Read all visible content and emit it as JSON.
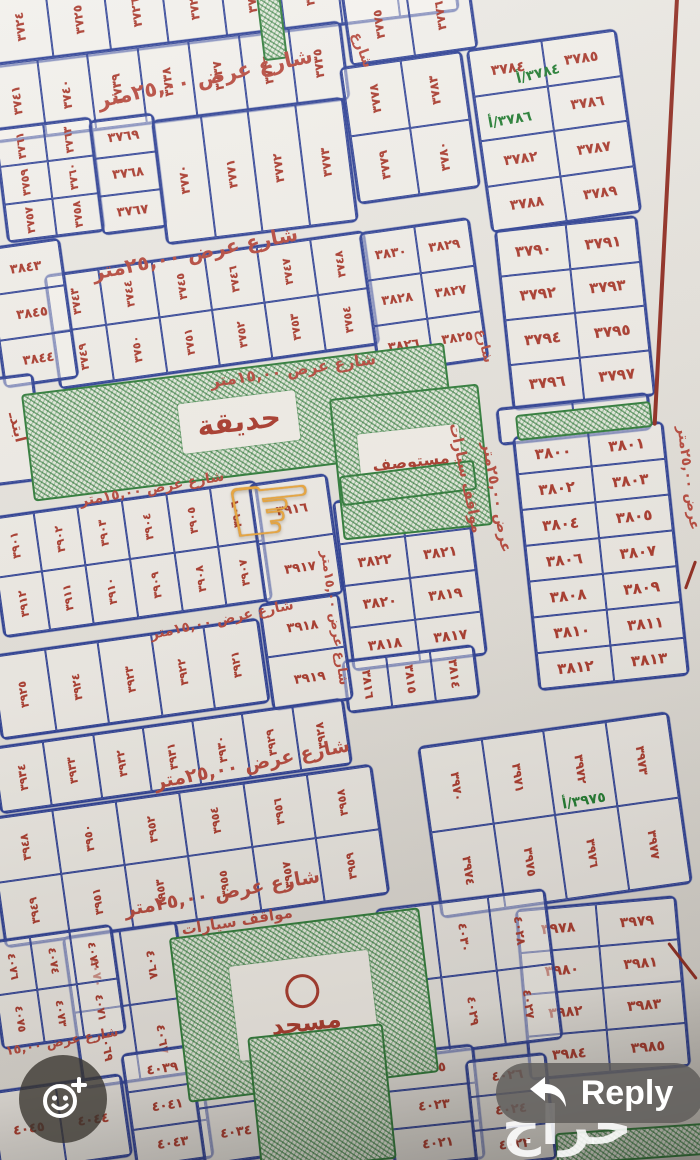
{
  "ui": {
    "reply_button": {
      "label": "Reply"
    },
    "watermark": "حراج"
  },
  "map": {
    "palette": {
      "ink_blue": "#2c3f94",
      "ink_red": "#a8392c",
      "ink_green": "#1f7a2f",
      "street_red": "#b5483c",
      "border_red": "#8f2b20",
      "paper": "#e6e3dd"
    },
    "pointer": {
      "glyph": "☞",
      "x": 224,
      "y": 462,
      "size": 104,
      "rot": -6,
      "target_plot": "٣٨٢٤"
    },
    "areas": [
      {
        "name": "garden",
        "label": "حديقة",
        "x": 26,
        "y": 368,
        "w": 422,
        "h": 104,
        "rot": -7,
        "hatch": true,
        "lw": 118,
        "lh": 50,
        "fs": 28
      },
      {
        "name": "clinic",
        "label": "مستوصف",
        "x": 336,
        "y": 391,
        "w": 146,
        "h": 138,
        "rot": -6,
        "hatch": true,
        "lw": 102,
        "lh": 66,
        "fs": 16
      },
      {
        "name": "mosque",
        "label": "مسجد",
        "x": 178,
        "y": 922,
        "w": 248,
        "h": 162,
        "rot": -7,
        "hatch": true,
        "lw": 140,
        "lh": 95,
        "fs": 24
      },
      {
        "name": "green-strip-top",
        "label": "",
        "x": 260,
        "y": -6,
        "w": 20,
        "h": 62,
        "rot": -7,
        "hatch": true
      },
      {
        "name": "green-strip-3800",
        "label": "",
        "x": 516,
        "y": 408,
        "w": 132,
        "h": 22,
        "rot": -6,
        "hatch": true
      },
      {
        "name": "green-strip-3824",
        "label": "",
        "x": 340,
        "y": 468,
        "w": 132,
        "h": 26,
        "rot": -7,
        "hatch": true
      },
      {
        "name": "green-block-bottom",
        "label": "",
        "x": 254,
        "y": 1030,
        "w": 132,
        "h": 132,
        "rot": -6,
        "hatch": true
      },
      {
        "name": "green-strip-bottom-right",
        "label": "",
        "x": 556,
        "y": 1128,
        "w": 148,
        "h": 28,
        "rot": -4,
        "hatch": true
      }
    ],
    "streets": [
      {
        "label": "شارع عرض ٢٥,٠٠متر",
        "x": 205,
        "y": 78,
        "rot": -12,
        "size": 21
      },
      {
        "label": "شارع",
        "x": 362,
        "y": 50,
        "rot": 70,
        "size": 14
      },
      {
        "label": "شارع عرض ٢٥,٠٠متر",
        "x": 195,
        "y": 253,
        "rot": -11,
        "size": 20
      },
      {
        "label": "شارع عرض ١٥,٠٠متر",
        "x": 293,
        "y": 370,
        "rot": -8,
        "size": 16
      },
      {
        "label": "شارع عرض ١٥,٠٠متر",
        "x": 152,
        "y": 489,
        "rot": -10,
        "size": 14
      },
      {
        "label": "مواقف سيارات",
        "x": 466,
        "y": 478,
        "rot": 78,
        "size": 15
      },
      {
        "label": "عرض ٢٥,٠٠متر",
        "x": 497,
        "y": 497,
        "rot": 80,
        "size": 15
      },
      {
        "label": "شارع عرض ١٥,٠٠متر",
        "x": 334,
        "y": 618,
        "rot": 82,
        "size": 13
      },
      {
        "label": "شارع عرض ١٥,٠٠متر",
        "x": 222,
        "y": 620,
        "rot": -12,
        "size": 14
      },
      {
        "label": "شارع عرض ٢٥,٠٠متر",
        "x": 252,
        "y": 764,
        "rot": -11,
        "size": 19
      },
      {
        "label": "شارع عرض ٢٥,٠٠متر",
        "x": 222,
        "y": 893,
        "rot": -10,
        "size": 19
      },
      {
        "label": "مواقف سيارات",
        "x": 237,
        "y": 921,
        "rot": -9,
        "size": 15
      },
      {
        "label": "شارع عرض ١٥,٠٠",
        "x": 62,
        "y": 1042,
        "rot": -10,
        "size": 13
      },
      {
        "label": "عرض ٢٥,٠٠متر",
        "x": 688,
        "y": 478,
        "rot": 83,
        "size": 14
      },
      {
        "label": "شارع",
        "x": 484,
        "y": 346,
        "rot": 76,
        "size": 13
      }
    ],
    "annotations": [
      {
        "text": "٣٧٨٤/أ",
        "x": 516,
        "y": 66,
        "rot": -14,
        "size": 14,
        "color": "#1f7a2f"
      },
      {
        "text": "٣٧٨٦/أ",
        "x": 488,
        "y": 112,
        "rot": -10,
        "size": 14,
        "color": "#1f7a2f"
      },
      {
        "text": "٣٩٧٥/أ",
        "x": 562,
        "y": 793,
        "rot": -10,
        "size": 14,
        "color": "#1f7a2f"
      },
      {
        "text": "ابتدـ",
        "x": 2,
        "y": 418,
        "rot": 76,
        "size": 15,
        "color": "#a8392c"
      }
    ],
    "strokes": [
      {
        "x": 664,
        "y": -10,
        "w": 4,
        "h": 436,
        "rot": 3
      },
      {
        "x": 681,
        "y": 938,
        "w": 3,
        "h": 46,
        "rot": -38
      },
      {
        "x": 689,
        "y": 560,
        "w": 3,
        "h": 30,
        "rot": 20
      }
    ],
    "blocks": [
      {
        "x": -12,
        "y": -36,
        "w": 465,
        "h": 72,
        "rot": -7,
        "cols": 8,
        "labelRot": -90,
        "size": 12,
        "cells": [
          "٣٧٢٤",
          "٣٧٢٥",
          "٣٧٢٦",
          "٣٧٢٧",
          "٣٧٢٨",
          "٣٧٢٩",
          "٣٧٣٠",
          "٣٧٣١"
        ]
      },
      {
        "x": -12,
        "y": 42,
        "w": 355,
        "h": 76,
        "rot": -7,
        "cols": 7,
        "labelRot": -90,
        "size": 12,
        "cells": [
          "٣٧٤١",
          "٣٧٤٠",
          "٣٧٣٩",
          "٣٧٣٨",
          "٣٧٣٧",
          "٣٧٣٦",
          "٣٧٣٥"
        ]
      },
      {
        "x": 345,
        "y": -18,
        "w": 125,
        "h": 72,
        "rot": -8,
        "cols": 2,
        "labelRot": -90,
        "size": 12,
        "cells": [
          "٣٧٧٥",
          "٣٧٧٦"
        ]
      },
      {
        "x": 348,
        "y": 58,
        "w": 120,
        "h": 135,
        "rot": -8,
        "cols": 2,
        "labelRot": -90,
        "size": 12,
        "cells": [
          "٣٧٧٨",
          "٣٧٨٣",
          "٣٧٧٩",
          "٣٧٨٠"
        ]
      },
      {
        "x": 478,
        "y": 38,
        "w": 148,
        "h": 182,
        "rot": -8,
        "cols": 2,
        "labelRot": 0,
        "size": 14,
        "cells": [
          "٣٧٨٤",
          "٣٧٨٥",
          "",
          "٣٧٨٦",
          "٣٧٨٢",
          "٣٧٨٧",
          "٣٧٨٨",
          "٣٧٨٩"
        ]
      },
      {
        "x": 0,
        "y": 122,
        "w": 95,
        "h": 112,
        "rot": -7,
        "cols": 2,
        "labelRot": -90,
        "size": 11,
        "cells": [
          "٣٧٦١",
          "٣٧٦٣",
          "٣٧٥٩",
          "٣٧٦٠",
          "٣٧٥٧",
          "٣٧٥٨"
        ]
      },
      {
        "x": 95,
        "y": 116,
        "w": 62,
        "h": 112,
        "rot": -7,
        "cols": 1,
        "labelRot": 0,
        "size": 13,
        "cells": [
          "٣٧٦٩",
          "٣٧٦٨",
          "٣٧٦٧"
        ]
      },
      {
        "x": 158,
        "y": 108,
        "w": 190,
        "h": 122,
        "rot": -7,
        "cols": 4,
        "labelRot": -90,
        "size": 12,
        "cells": [
          "٣٧٧٠",
          "٣٧٧١",
          "٣٧٧٢",
          "٣٧٧٣"
        ]
      },
      {
        "x": 50,
        "y": 252,
        "w": 320,
        "h": 112,
        "rot": -8,
        "cols": 6,
        "labelRot": -90,
        "size": 11,
        "cells": [
          "٣٧٤٣",
          "٣٧٤٤",
          "٣٧٤٥",
          "٣٧٤٦",
          "٣٧٤٧",
          "٣٧٤٨",
          "٣٧٤٩",
          "٣٧٥٠",
          "٣٧٥١",
          "٣٧٥٢",
          "٣٧٥٣",
          "٣٧٥٤"
        ]
      },
      {
        "x": -6,
        "y": 242,
        "w": 72,
        "h": 138,
        "rot": -8,
        "cols": 1,
        "labelRot": 0,
        "size": 13,
        "cells": [
          "٣٨٤٣",
          "٣٨٤٥",
          "٣٨٤٤"
        ]
      },
      {
        "x": 368,
        "y": 224,
        "w": 108,
        "h": 140,
        "rot": -8,
        "cols": 2,
        "labelRot": 0,
        "size": 13,
        "cells": [
          "٣٨٣٠",
          "٣٨٢٩",
          "٣٨٢٨",
          "٣٨٢٧",
          "٣٨٢٦",
          "٣٨٢٥"
        ]
      },
      {
        "x": 503,
        "y": 222,
        "w": 140,
        "h": 178,
        "rot": -6,
        "cols": 2,
        "labelRot": 0,
        "size": 15,
        "cells": [
          "٣٧٩٠",
          "٣٧٩١",
          "٣٧٩٢",
          "٣٧٩٣",
          "٣٧٩٤",
          "٣٧٩٥",
          "٣٧٩٦",
          "٣٧٩٧"
        ]
      },
      {
        "x": 497,
        "y": 400,
        "w": 150,
        "h": 34,
        "rot": -6,
        "cols": 2,
        "labelRot": 0,
        "size": 15,
        "cells": [
          "٣٧٩٨",
          "٣٧٩٩"
        ]
      },
      {
        "x": 525,
        "y": 428,
        "w": 148,
        "h": 252,
        "rot": -6,
        "cols": 2,
        "labelRot": 0,
        "size": 15,
        "cells": [
          "٣٨٠٠",
          "٣٨٠١",
          "٣٨٠٢",
          "٣٨٠٣",
          "٣٨٠٤",
          "٣٨٠٥",
          "٣٨٠٦",
          "٣٨٠٧",
          "٣٨٠٨",
          "٣٨٠٩",
          "٣٨١٠",
          "٣٨١١",
          "٣٨١٢",
          "٣٨١٣"
        ]
      },
      {
        "x": 342,
        "y": 492,
        "w": 132,
        "h": 168,
        "rot": -7,
        "cols": 2,
        "labelRot": 0,
        "size": 14,
        "cells": [
          "٣٨٢٤",
          "٣٨٢٣",
          "٣٨٢٢",
          "٣٨٢١",
          "٣٨٢٠",
          "٣٨١٩",
          "٣٨١٨",
          "٣٨١٧"
        ]
      },
      {
        "x": 344,
        "y": 652,
        "w": 130,
        "h": 50,
        "rot": -7,
        "cols": 3,
        "labelRot": 90,
        "size": 12,
        "cells": [
          "٣٨١٦",
          "٣٨١٥",
          "٣٨١٤"
        ]
      },
      {
        "x": -6,
        "y": 498,
        "w": 268,
        "h": 118,
        "rot": -8,
        "cols": 6,
        "labelRot": -90,
        "size": 11,
        "cells": [
          "٣٩٠١",
          "٣٩٠٢",
          "٣٩٠٣",
          "٣٩٠٤",
          "٣٩٠٥",
          "٣٩٠٦",
          "٣٩١٢",
          "٣٩١١",
          "٣٩١٠",
          "٣٩٠٩",
          "٣٩٠٨",
          "٣٩٠٧"
        ]
      },
      {
        "x": 256,
        "y": 478,
        "w": 76,
        "h": 118,
        "rot": -8,
        "cols": 1,
        "labelRot": 0,
        "size": 13,
        "cells": [
          "٣٩١٦",
          "٣٩١٧"
        ]
      },
      {
        "x": 265,
        "y": 598,
        "w": 78,
        "h": 104,
        "rot": -8,
        "cols": 1,
        "labelRot": 0,
        "size": 13,
        "cells": [
          "٣٩١٨",
          "٣٩١٩"
        ]
      },
      {
        "x": -6,
        "y": 636,
        "w": 268,
        "h": 82,
        "rot": -8,
        "cols": 5,
        "labelRot": -90,
        "size": 11,
        "cells": [
          "٣٩٢٥",
          "٣٩٢٤",
          "٣٩٢٣",
          "٣٩٢٢",
          "٣٩٢١"
        ]
      },
      {
        "x": -6,
        "y": 722,
        "w": 352,
        "h": 64,
        "rot": -8,
        "cols": 7,
        "labelRot": -90,
        "size": 11,
        "cells": [
          "٣٩٣٤",
          "٣٩٣٣",
          "٣٩٣٢",
          "٣٩٣١",
          "٣٩٣٠",
          "٣٩٢٩",
          "٣٩٢٨"
        ]
      },
      {
        "x": -6,
        "y": 790,
        "w": 385,
        "h": 128,
        "rot": -8,
        "cols": 6,
        "labelRot": -90,
        "size": 11,
        "cells": [
          "٣٩٤٨",
          "٣٩٥٠",
          "٣٩٥٢",
          "٣٩٥٤",
          "٣٩٥٦",
          "٣٩٥٨",
          "٣٩٤٩",
          "٣٩٥١",
          "٣٩٥٣",
          "٣٩٥٥",
          "٣٩٥٧",
          "٣٩٥٩"
        ]
      },
      {
        "x": 428,
        "y": 728,
        "w": 250,
        "h": 170,
        "rot": -8,
        "cols": 4,
        "labelRot": 90,
        "size": 12,
        "cells": [
          "٣٩٧٠",
          "٣٩٧١",
          "٣٩٧٢",
          "٣٩٧٣",
          "٣٩٧٤",
          "٣٩٧٥",
          "٣٩٧٦",
          "٣٩٧٧"
        ]
      },
      {
        "x": 522,
        "y": 902,
        "w": 158,
        "h": 168,
        "rot": -5,
        "cols": 2,
        "labelRot": 0,
        "size": 14,
        "cells": [
          "٣٩٧٨",
          "٣٩٧٩",
          "٣٩٨٠",
          "٣٩٨١",
          "٣٩٨٢",
          "٣٩٨٣",
          "٣٩٨٤",
          "٣٩٨٥"
        ]
      },
      {
        "x": 383,
        "y": 898,
        "w": 168,
        "h": 148,
        "rot": -7,
        "cols": 3,
        "labelRot": 90,
        "size": 12,
        "cells": [
          "٤٠٣٢",
          "٤٠٣٠",
          "٤٠٢٨",
          "٤٠٣١",
          "٤٠٢٩",
          "٤٠٢٧"
        ]
      },
      {
        "x": 72,
        "y": 928,
        "w": 112,
        "h": 150,
        "rot": -8,
        "cols": 2,
        "labelRot": 90,
        "size": 12,
        "cells": [
          "٤٠٧٠",
          "٤٠٦٨",
          "٤٠٦٩",
          "٤٠٦٧"
        ]
      },
      {
        "x": -6,
        "y": 932,
        "w": 122,
        "h": 106,
        "rot": -8,
        "cols": 3,
        "labelRot": 90,
        "size": 11,
        "cells": [
          "٤٠٧٦",
          "٤٠٧٤",
          "٤٠٧٢",
          "٤٠٧٥",
          "٤٠٧٣",
          "٤٠٧١"
        ]
      },
      {
        "x": 128,
        "y": 1048,
        "w": 75,
        "h": 112,
        "rot": -8,
        "cols": 1,
        "labelRot": 0,
        "size": 13,
        "cells": [
          "٤٠٣٩",
          "٤٠٤١",
          "٤٠٤٣"
        ]
      },
      {
        "x": 196,
        "y": 1046,
        "w": 68,
        "h": 112,
        "rot": -8,
        "cols": 1,
        "labelRot": 0,
        "size": 13,
        "cells": [
          "٤٠٣٣",
          "٤٠٣٤"
        ]
      },
      {
        "x": -6,
        "y": 1082,
        "w": 130,
        "h": 80,
        "rot": -8,
        "cols": 2,
        "labelRot": 0,
        "size": 13,
        "cells": [
          "٤٠٤٥",
          "٤٠٤٤"
        ]
      },
      {
        "x": 388,
        "y": 1048,
        "w": 88,
        "h": 112,
        "rot": -6,
        "cols": 1,
        "labelRot": 0,
        "size": 13,
        "cells": [
          "٤٠٢٥",
          "٤٠٢٣",
          "٤٠٢١"
        ]
      },
      {
        "x": 470,
        "y": 1056,
        "w": 78,
        "h": 104,
        "rot": -6,
        "cols": 1,
        "labelRot": 0,
        "size": 13,
        "cells": [
          "٤٠٢٦",
          "٤٠٢٤",
          "٤٠٢٢"
        ]
      },
      {
        "x": -22,
        "y": 376,
        "w": 58,
        "h": 104,
        "rot": -7,
        "cols": 1,
        "labelRot": 0,
        "size": 12,
        "cells": [
          ""
        ]
      }
    ]
  }
}
